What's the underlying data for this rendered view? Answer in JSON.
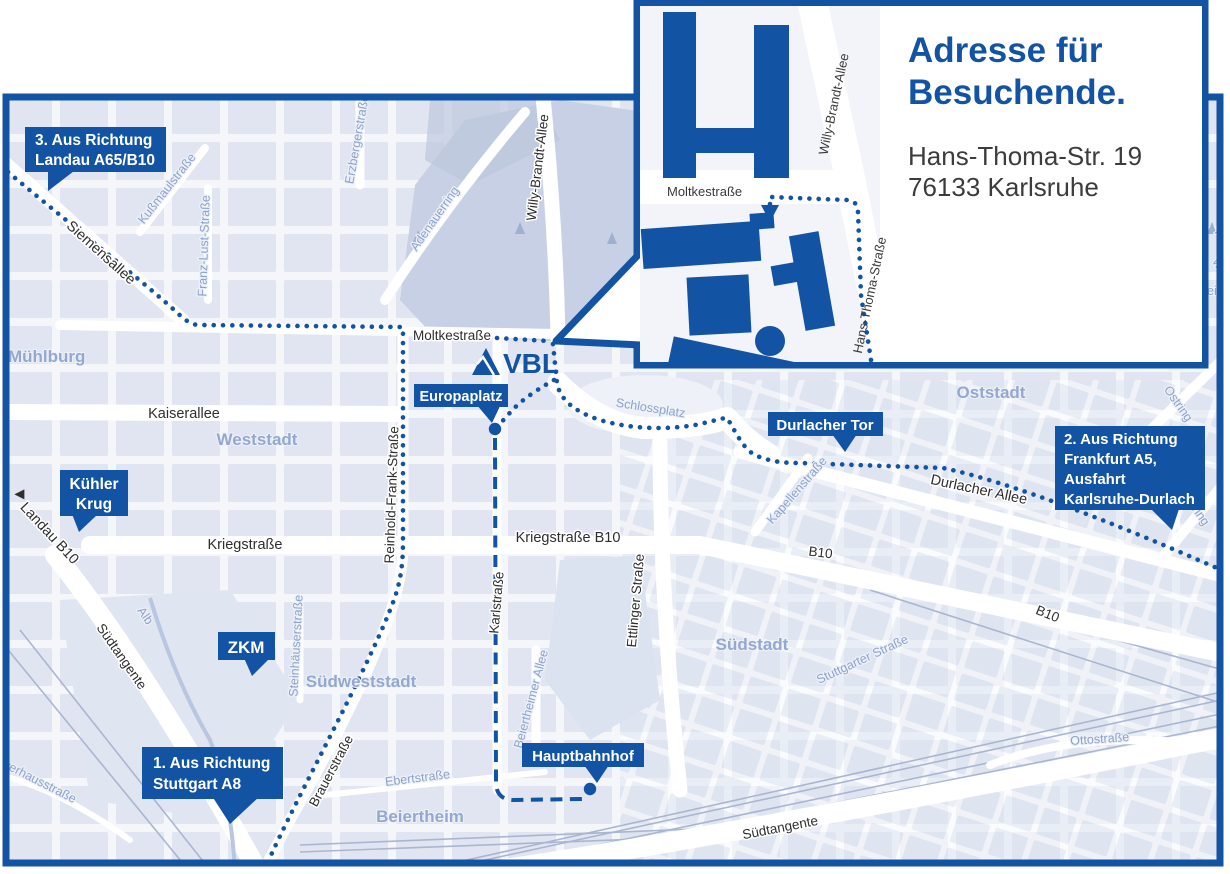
{
  "colors": {
    "accent": "#1353a3",
    "map_background": "#e7ecf5",
    "city_block": "#d8dfee",
    "park": "#c7d0e4",
    "district_label": "#93a8d0",
    "street_label": "#2e2e2e",
    "light_street_label": "#8ba2cd",
    "road": "#ffffff",
    "address_text": "#3c3c3c"
  },
  "inset": {
    "title_line1": "Adresse für",
    "title_line2": "Besuchende.",
    "address_line1": "Hans-Thoma-Str. 19",
    "address_line2": "76133 Karlsruhe",
    "streets": {
      "moltkestrasse": "Moltkestraße",
      "willy_brandt_allee": "Willy-Brandt-Allee",
      "hans_thoma_strasse": "Hans-Thoma-Straße"
    }
  },
  "brand": {
    "logo_text": "VBL"
  },
  "callouts": {
    "landau": {
      "line1": "3. Aus Richtung",
      "line2": "Landau A65/B10"
    },
    "frankfurt": {
      "line1": "2. Aus Richtung",
      "line2": "Frankfurt A5,",
      "line3": "Ausfahrt",
      "line4": "Karlsruhe-Durlach"
    },
    "stuttgart": {
      "line1": "1. Aus Richtung",
      "line2": "Stuttgart A8"
    },
    "kuehler_krug": {
      "line1": "Kühler",
      "line2": "Krug"
    },
    "zkm": {
      "label": "ZKM"
    },
    "europaplatz": {
      "label": "Europaplatz"
    },
    "durlacher_tor": {
      "label": "Durlacher Tor"
    },
    "hauptbahnhof": {
      "label": "Hauptbahnhof"
    }
  },
  "streets": {
    "siemensallee": "Siemensallee",
    "kussmaulstrasse": "Kußmaulstraße",
    "franz_lust_strasse": "Franz-Lust-Straße",
    "erzbergerstrasse": "Erzbergerstraße",
    "adenauerring": "Adenauerring",
    "willy_brandt_allee": "Willy-Brandt-Allee",
    "moltkestrasse": "Moltkestraße",
    "kaiserallee": "Kaiserallee",
    "kriegstrasse": "Kriegstraße",
    "kriegstrasse_b10": "Kriegstraße B10",
    "reinhold_frank_strasse": "Reinhold-Frank-Straße",
    "landau_b10": "Landau B10",
    "suedtangente_west": "Südtangente",
    "suedtangente_sued": "Südtangente",
    "alb": "Alb",
    "pulverhausstrasse": "Pulverhausstraße",
    "steinhaeuserstrasse": "Steinhäuserstraße",
    "brauerstrasse": "Brauerstraße",
    "ebertstrasse": "Ebertstraße",
    "karlstrasse": "Karlstraße",
    "beiertheimer_allee": "Beiertheimer Allee",
    "ettlinger_strasse": "Ettlinger Straße",
    "schlossplatz": "Schlossplatz",
    "kapellenstrasse": "Kapellenstraße",
    "durlacher_allee": "Durlacher Allee",
    "b10_mid": "B10",
    "b10_suedost": "B10",
    "stuttgarter_strasse": "Stuttgarter Straße",
    "ottostrasse": "Ottostraße",
    "ostring_nord": "Ostring",
    "ostring_sued": "Ostring"
  },
  "districts": {
    "muehlburg": "Mühlburg",
    "weststadt": "Weststadt",
    "suedweststadt": "Südweststadt",
    "suedstadt": "Südstadt",
    "oststadt": "Oststadt",
    "beiertheim": "Beiertheim"
  },
  "edge_fragments": {
    "f1": "Hai",
    "f2": "we",
    "f3": "ein"
  }
}
